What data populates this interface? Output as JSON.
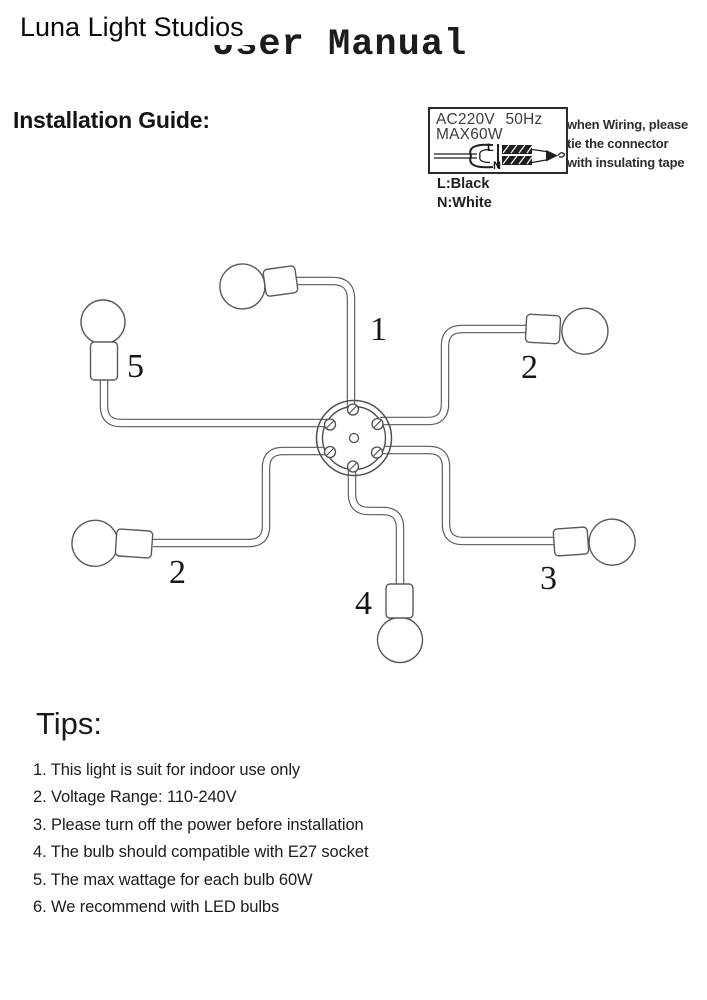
{
  "watermark": "Luna Light Studios",
  "title": "User Manual",
  "installation": {
    "heading": "Installation Guide:",
    "spec_box": {
      "voltage": "AC220V 50Hz",
      "wattage": "MAX60W",
      "wire_live": "L",
      "wire_neutral": "N"
    },
    "wiring_note": {
      "line1": "when Wiring, please",
      "line2": "tie the connector",
      "line3": "with insulating tape"
    },
    "legend": {
      "live": "L:Black",
      "neutral": "N:White"
    }
  },
  "diagram": {
    "arm_labels": {
      "top": "1",
      "upper_right": "2",
      "upper_left": "5",
      "lower_left": "2",
      "lower_right": "3",
      "bottom": "4"
    }
  },
  "tips": {
    "heading": "Tips:",
    "items": [
      "1. This light is suit for indoor use only",
      "2. Voltage Range: 110-240V",
      "3. Please turn off the power before installation",
      "4. The bulb should compatible with E27 socket",
      "5. The max wattage for each bulb 60W",
      "6. We recommend with LED bulbs"
    ]
  },
  "colors": {
    "ink": "#1c1c1c",
    "diagram_line": "#5a5a5a",
    "background": "#ffffff"
  }
}
